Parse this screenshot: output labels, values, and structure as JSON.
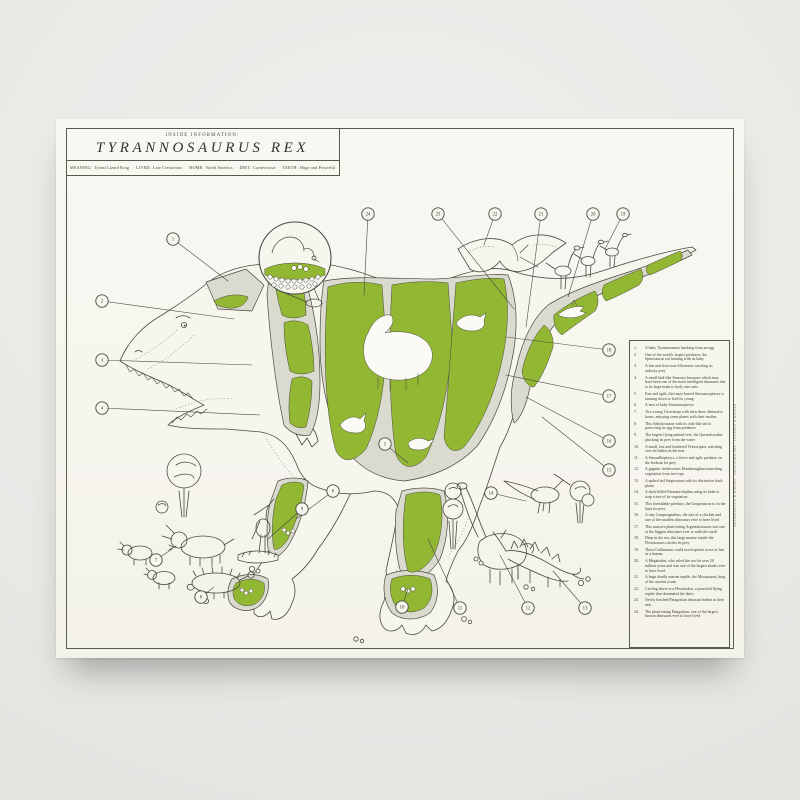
{
  "poster": {
    "eyebrow": "INSIDE INFORMATION:",
    "title": "TYRANNOSAURUS REX",
    "meta": [
      {
        "label": "MEANING:",
        "value": "Tyrant Lizard King"
      },
      {
        "label": "LIVED:",
        "value": "Late Cretaceous"
      },
      {
        "label": "HOME:",
        "value": "North America"
      },
      {
        "label": "DIET:",
        "value": "Carnivorous"
      },
      {
        "label": "TEETH:",
        "value": "Huge and Powerful"
      }
    ],
    "credit": "DESIGN & CONCEPT · ART DIRECTION · DESIGN & ILLUSTRATION"
  },
  "colors": {
    "accent_green": "#92b733",
    "ink": "#4a4942",
    "paper": "#f6f5ee",
    "panel_gray": "#dbdacf",
    "wall": "#e9e8e5"
  },
  "legend": {
    "items": [
      {
        "num": "1.",
        "text": "A baby Tyrannosaurus hatching from an egg"
      },
      {
        "num": "2.",
        "text": "One of the world's largest predators, the Spinosaurus out hunting with its baby"
      },
      {
        "num": "3.",
        "text": "A fast and ferocious Allosaurus catching its unlucky prey"
      },
      {
        "num": "4.",
        "text": "A small bird-like Stenonychosaurus which may have been one of the more intelligent dinosaurs due to its large brain to body size ratio"
      },
      {
        "num": "5.",
        "text": "Fast and agile, the fuzzy-haired Sinosauropteryx is running down to feed its young"
      },
      {
        "num": "6.",
        "text": "A nest of baby Sinosauropteryx"
      },
      {
        "num": "7.",
        "text": "Two young Triceratops with their three distinctive horns, enjoying some plants with their mother"
      },
      {
        "num": "8.",
        "text": "This Ankylosaurus with its club-like tail is protecting its egg from predators"
      },
      {
        "num": "9.",
        "text": "The largest flying animal ever, the Quetzalcoatlus plucking its prey from the water"
      },
      {
        "num": "10.",
        "text": "A small, fast and feathered Velociraptor watching over its babies in the nest"
      },
      {
        "num": "11.",
        "text": "A Sinocalliopteryx, a fierce and agile predator on the lookout for prey"
      },
      {
        "num": "12.",
        "text": "A gigantic herbivorous Dreadnoughtus munching vegetation from tree tops"
      },
      {
        "num": "13.",
        "text": "A spiked tail Stegosaurus with its distinctive back plates"
      },
      {
        "num": "14.",
        "text": "A duck-billed Parasaurolophus using its beak to strip a tree of its vegetation"
      },
      {
        "num": "15.",
        "text": "This formidable predator, the Gorgosaurus is on the hunt for prey"
      },
      {
        "num": "16.",
        "text": "A tiny Compsognathus, the size of a chicken and one of the smallest dinosaurs ever to have lived"
      },
      {
        "num": "17.",
        "text": "This massive plant-eating Argentinosaurus was one of the biggest dinosaurs ever to walk the earth"
      },
      {
        "num": "18.",
        "text": "Deep in the sea, this large marine reptile the Plesiosaurus catches its prey"
      },
      {
        "num": "19.",
        "text": "These Gallimimus could reach speeds twice as fast as a human"
      },
      {
        "num": "20.",
        "text": "A Megalodon, who ruled the sea for over 20 million years and was one of the largest sharks ever to have lived"
      },
      {
        "num": "21.",
        "text": "A huge deadly marine reptile, the Mosasaurus, king of the ancient ocean"
      },
      {
        "num": "22.",
        "text": "Circling above is a Pteranodon, a powerful flying reptile that dominated the skies"
      },
      {
        "num": "23.",
        "text": "Newly hatched Patagotitan dinosaur babies in their nest"
      },
      {
        "num": "24.",
        "text": "The plant-eating Patagotitan, one of the largest known dinosaurs ever to have lived"
      }
    ]
  },
  "callouts": [
    {
      "n": "1",
      "cx": 117,
      "cy": 120,
      "tx": 172,
      "ty": 162
    },
    {
      "n": "2",
      "cx": 46,
      "cy": 182,
      "tx": 178,
      "ty": 200
    },
    {
      "n": "3",
      "cx": 46,
      "cy": 241,
      "tx": 196,
      "ty": 246
    },
    {
      "n": "4",
      "cx": 46,
      "cy": 289,
      "tx": 204,
      "ty": 296
    },
    {
      "n": "5",
      "cx": 329,
      "cy": 325,
      "tx": 352,
      "ty": 344
    },
    {
      "n": "6",
      "cx": 277,
      "cy": 372,
      "tx": 240,
      "ty": 400
    },
    {
      "n": "7",
      "cx": 100,
      "cy": 441,
      "tx": 116,
      "ty": 430
    },
    {
      "n": "8",
      "cx": 145,
      "cy": 478,
      "tx": 158,
      "ty": 468
    },
    {
      "n": "9",
      "cx": 246,
      "cy": 390,
      "tx": 212,
      "ty": 420
    },
    {
      "n": "10",
      "cx": 346,
      "cy": 488,
      "tx": 352,
      "ty": 470
    },
    {
      "n": "11",
      "cx": 404,
      "cy": 489,
      "tx": 372,
      "ty": 420
    },
    {
      "n": "12",
      "cx": 472,
      "cy": 489,
      "tx": 444,
      "ty": 436
    },
    {
      "n": "13",
      "cx": 529,
      "cy": 489,
      "tx": 497,
      "ty": 452
    },
    {
      "n": "14",
      "cx": 435,
      "cy": 374,
      "tx": 470,
      "ty": 382
    },
    {
      "n": "15",
      "cx": 553,
      "cy": 351,
      "tx": 486,
      "ty": 298
    },
    {
      "n": "16",
      "cx": 553,
      "cy": 322,
      "tx": 470,
      "ty": 278
    },
    {
      "n": "17",
      "cx": 553,
      "cy": 277,
      "tx": 450,
      "ty": 256
    },
    {
      "n": "18",
      "cx": 553,
      "cy": 231,
      "tx": 450,
      "ty": 218
    },
    {
      "n": "19",
      "cx": 567,
      "cy": 95,
      "tx": 549,
      "ty": 130
    },
    {
      "n": "20",
      "cx": 537,
      "cy": 95,
      "tx": 512,
      "ty": 178
    },
    {
      "n": "21",
      "cx": 485,
      "cy": 95,
      "tx": 470,
      "ty": 208
    },
    {
      "n": "22",
      "cx": 439,
      "cy": 95,
      "tx": 428,
      "ty": 126
    },
    {
      "n": "23",
      "cx": 382,
      "cy": 95,
      "tx": 458,
      "ty": 190
    },
    {
      "n": "24",
      "cx": 312,
      "cy": 95,
      "tx": 308,
      "ty": 176
    }
  ]
}
